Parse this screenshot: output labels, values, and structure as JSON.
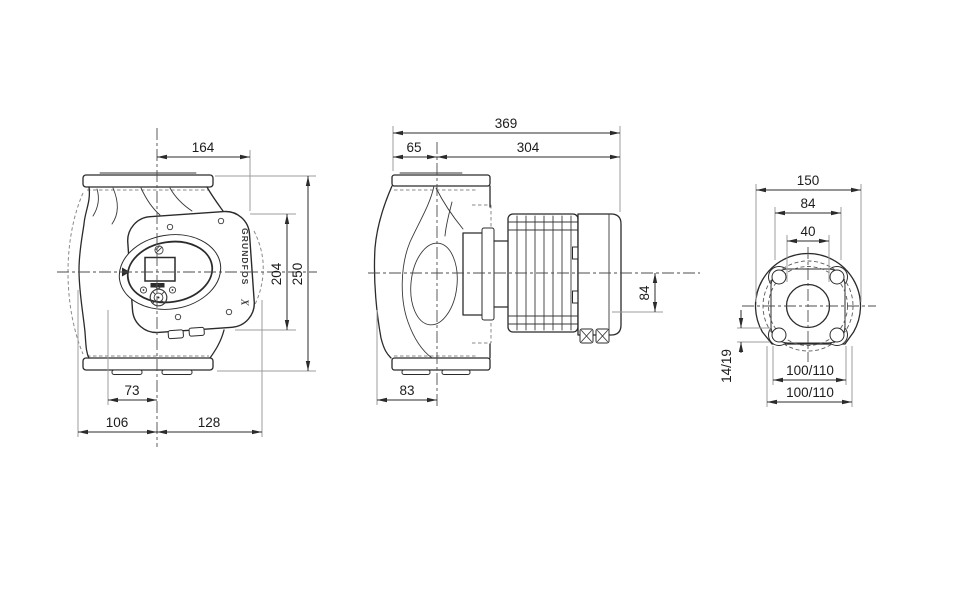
{
  "palette": {
    "ink": "#2b2b2b",
    "extension_line": "#9c9c9c",
    "hidden_line": "#8a8a8a"
  },
  "brand": {
    "logo_text": "GRUNDFOS",
    "logo_mark": "X"
  },
  "front_view": {
    "dims": {
      "width_center_to_panel": "164",
      "panel_height": "204",
      "total_height": "250",
      "foot_to_center": "73",
      "center_to_left": "106",
      "center_to_right": "128"
    }
  },
  "side_view": {
    "dims": {
      "total_length": "369",
      "front_to_axis": "65",
      "axis_to_rear": "304",
      "axis_to_bottom": "84",
      "housing_depth": "83"
    }
  },
  "flange_view": {
    "dims": {
      "outer_diameter": "150",
      "pad_spacing": "84",
      "bore_diameter": "40",
      "hole_diameter": "14/19",
      "bolt_circle_upper": "100/110",
      "bolt_circle_lower": "100/110"
    }
  }
}
